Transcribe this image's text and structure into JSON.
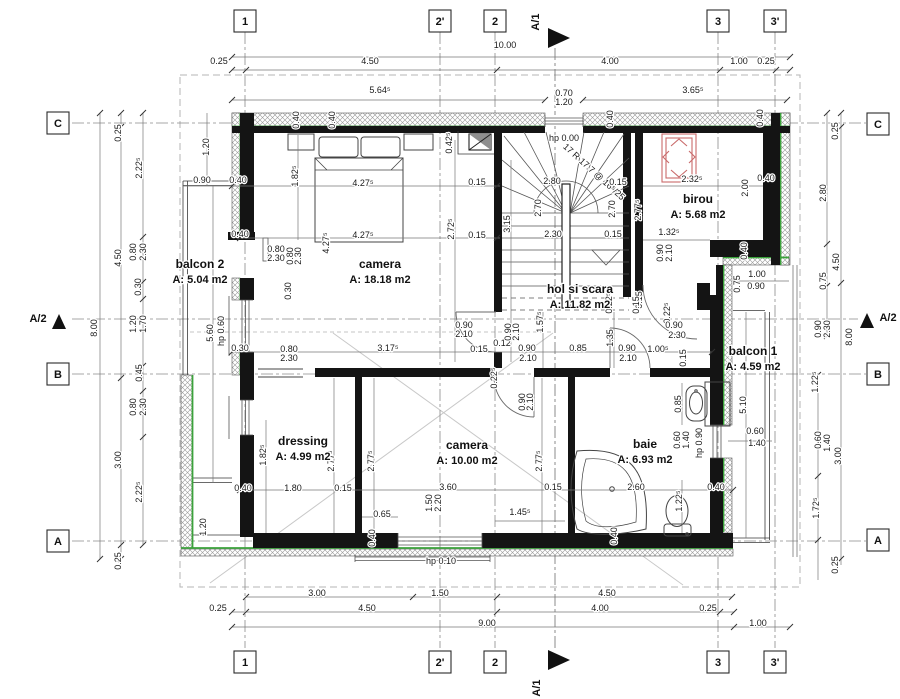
{
  "drawing": {
    "type": "architectural floor plan",
    "level_note_visible": false
  },
  "colors": {
    "wall": "#141414",
    "insulation_green": "#3ba23b",
    "red_element": "#c96a6a",
    "dim_text": "#1a1a1a",
    "grid_line": "#8a8a8a",
    "roof_dash": "#b5b5b5"
  },
  "rooms": [
    {
      "name": "balcon 2",
      "area": "A: 5.04 m2",
      "x": 200,
      "y": 268
    },
    {
      "name": "camera",
      "area": "A: 18.18 m2",
      "x": 380,
      "y": 268
    },
    {
      "name": "hol si scara",
      "area": "A: 11.82 m2",
      "x": 580,
      "y": 293
    },
    {
      "name": "birou",
      "area": "A: 5.68 m2",
      "x": 698,
      "y": 203
    },
    {
      "name": "dressing",
      "area": "A: 4.99 m2",
      "x": 303,
      "y": 445
    },
    {
      "name": "camera",
      "area": "A: 10.00 m2",
      "x": 467,
      "y": 449
    },
    {
      "name": "baie",
      "area": "A: 6.93 m2",
      "x": 645,
      "y": 448
    },
    {
      "name": "balcon 1",
      "area": "A: 4.59 m2",
      "x": 753,
      "y": 355
    }
  ],
  "grid": {
    "bubbles": [
      {
        "label": "1",
        "x": 245,
        "y": 21
      },
      {
        "label": "2'",
        "x": 440,
        "y": 21
      },
      {
        "label": "2",
        "x": 495,
        "y": 21
      },
      {
        "label": "3",
        "x": 718,
        "y": 21
      },
      {
        "label": "3'",
        "x": 775,
        "y": 21
      },
      {
        "label": "1",
        "x": 245,
        "y": 662
      },
      {
        "label": "2'",
        "x": 440,
        "y": 662
      },
      {
        "label": "2",
        "x": 495,
        "y": 662
      },
      {
        "label": "3",
        "x": 718,
        "y": 662
      },
      {
        "label": "3'",
        "x": 775,
        "y": 662
      },
      {
        "label": "C",
        "x": 58,
        "y": 123
      },
      {
        "label": "B",
        "x": 58,
        "y": 374
      },
      {
        "label": "A",
        "x": 58,
        "y": 541
      },
      {
        "label": "C",
        "x": 878,
        "y": 124
      },
      {
        "label": "B",
        "x": 878,
        "y": 374
      },
      {
        "label": "A",
        "x": 878,
        "y": 540
      }
    ]
  },
  "sections": [
    {
      "label": "A/1",
      "lx": 539,
      "ly": 22,
      "lr": -90,
      "tri": "548,28 548,48 570,38"
    },
    {
      "label": "A/1",
      "lx": 540,
      "ly": 688,
      "lr": -90,
      "tri": "548,650 548,670 570,660"
    },
    {
      "label": "A/2",
      "lx": 38,
      "ly": 322,
      "lr": 0,
      "tri": "52,329 66,329 59,314"
    },
    {
      "label": "A/2",
      "lx": 888,
      "ly": 321,
      "lr": 0,
      "tri": "860,328 874,328 867,313"
    }
  ],
  "dims": [
    {
      "t": "10.00",
      "x": 505,
      "y": 48
    },
    {
      "t": "0.25",
      "x": 219,
      "y": 64
    },
    {
      "t": "4.50",
      "x": 370,
      "y": 64
    },
    {
      "t": "4.00",
      "x": 610,
      "y": 64
    },
    {
      "t": "1.00",
      "x": 739,
      "y": 64
    },
    {
      "t": "0.25",
      "x": 766,
      "y": 64
    },
    {
      "t": "5.64⁵",
      "x": 380,
      "y": 93
    },
    {
      "t": "3.65⁵",
      "x": 693,
      "y": 93
    },
    {
      "t": "0.70",
      "x": 564,
      "y": 96,
      "s": 8
    },
    {
      "t": "1.20",
      "x": 564,
      "y": 105,
      "s": 8
    },
    {
      "t": "3.00",
      "x": 317,
      "y": 596
    },
    {
      "t": "1.50",
      "x": 440,
      "y": 596
    },
    {
      "t": "4.50",
      "x": 607,
      "y": 596
    },
    {
      "t": "0.25",
      "x": 218,
      "y": 611
    },
    {
      "t": "4.50",
      "x": 367,
      "y": 611
    },
    {
      "t": "4.00",
      "x": 600,
      "y": 611
    },
    {
      "t": "0.25",
      "x": 708,
      "y": 611
    },
    {
      "t": "9.00",
      "x": 487,
      "y": 626
    },
    {
      "t": "1.00",
      "x": 758,
      "y": 626
    },
    {
      "t": "8.00",
      "x": 97,
      "y": 328,
      "r": -90
    },
    {
      "t": "0.25",
      "x": 121,
      "y": 133,
      "r": -90
    },
    {
      "t": "4.50",
      "x": 121,
      "y": 258,
      "r": -90
    },
    {
      "t": "3.00",
      "x": 121,
      "y": 460,
      "r": -90
    },
    {
      "t": "0.25",
      "x": 121,
      "y": 561,
      "r": -90
    },
    {
      "t": "2.22⁵",
      "x": 142,
      "y": 168,
      "r": -90
    },
    {
      "t": "0.80",
      "x": 136,
      "y": 252,
      "r": -90
    },
    {
      "t": "2.30",
      "x": 146,
      "y": 252,
      "r": -90
    },
    {
      "t": "0.30",
      "x": 141,
      "y": 287,
      "r": -90
    },
    {
      "t": "1.20",
      "x": 136,
      "y": 324,
      "r": -90
    },
    {
      "t": "1.70",
      "x": 146,
      "y": 324,
      "r": -90
    },
    {
      "t": "0.45",
      "x": 142,
      "y": 373,
      "r": -90
    },
    {
      "t": "0.80",
      "x": 136,
      "y": 407,
      "r": -90
    },
    {
      "t": "2.30",
      "x": 146,
      "y": 407,
      "r": -90
    },
    {
      "t": "2.22⁵",
      "x": 142,
      "y": 492,
      "r": -90
    },
    {
      "t": "1.20",
      "x": 209,
      "y": 147,
      "r": -90
    },
    {
      "t": "0.90",
      "x": 202,
      "y": 183
    },
    {
      "t": "5.60",
      "x": 213,
      "y": 333,
      "r": -90
    },
    {
      "t": "hp 0.60",
      "x": 224,
      "y": 331,
      "r": -90,
      "s": 7.5
    },
    {
      "t": "1.20",
      "x": 206,
      "y": 527,
      "r": -90
    },
    {
      "t": "0.25",
      "x": 838,
      "y": 131,
      "r": -90
    },
    {
      "t": "2.80",
      "x": 826,
      "y": 193,
      "r": -90
    },
    {
      "t": "4.50",
      "x": 839,
      "y": 262,
      "r": -90
    },
    {
      "t": "0.75",
      "x": 826,
      "y": 281,
      "r": -90
    },
    {
      "t": "0.90",
      "x": 821,
      "y": 329,
      "r": -90
    },
    {
      "t": "2.30",
      "x": 830,
      "y": 329,
      "r": -90
    },
    {
      "t": "8.00",
      "x": 852,
      "y": 337,
      "r": -90
    },
    {
      "t": "1.22⁵",
      "x": 818,
      "y": 382,
      "r": -90
    },
    {
      "t": "0.60",
      "x": 821,
      "y": 440,
      "r": -90
    },
    {
      "t": "1.40",
      "x": 830,
      "y": 443,
      "r": -90
    },
    {
      "t": "3.00",
      "x": 841,
      "y": 456,
      "r": -90
    },
    {
      "t": "1.72⁵",
      "x": 819,
      "y": 508,
      "r": -90
    },
    {
      "t": "0.25",
      "x": 838,
      "y": 565,
      "r": -90
    },
    {
      "t": "0.40",
      "x": 238,
      "y": 183
    },
    {
      "t": "0.40",
      "x": 240,
      "y": 237
    },
    {
      "t": "1.82⁵",
      "x": 298,
      "y": 176,
      "r": -90
    },
    {
      "t": "4.27⁵",
      "x": 363,
      "y": 186
    },
    {
      "t": "4.27⁵",
      "x": 363,
      "y": 238
    },
    {
      "t": "4.27⁵",
      "x": 329,
      "y": 243,
      "r": -90
    },
    {
      "t": "0.80",
      "x": 276,
      "y": 252
    },
    {
      "t": "2.30",
      "x": 276,
      "y": 261
    },
    {
      "t": "0.80",
      "x": 293,
      "y": 256,
      "r": -90
    },
    {
      "t": "2.30",
      "x": 301,
      "y": 256,
      "r": -90
    },
    {
      "t": "0.30",
      "x": 291,
      "y": 291,
      "r": -90
    },
    {
      "t": "2.72⁵",
      "x": 454,
      "y": 229,
      "r": -90
    },
    {
      "t": "0.15",
      "x": 477,
      "y": 185
    },
    {
      "t": "0.15",
      "x": 477,
      "y": 238
    },
    {
      "t": "0.42⁵",
      "x": 452,
      "y": 143,
      "r": -90
    },
    {
      "t": "0.40",
      "x": 299,
      "y": 120,
      "r": -90,
      "s": 8
    },
    {
      "t": "0.40",
      "x": 335,
      "y": 120,
      "r": -90,
      "s": 8
    },
    {
      "t": "0.40",
      "x": 613,
      "y": 119,
      "r": -90,
      "s": 8
    },
    {
      "t": "0.40",
      "x": 763,
      "y": 118,
      "r": -90,
      "s": 8
    },
    {
      "t": "hp 0.00",
      "x": 564,
      "y": 141,
      "s": 8
    },
    {
      "t": "17 R 17.7 @ 16⁵/25",
      "x": 592,
      "y": 174,
      "r": 42,
      "s": 7.5
    },
    {
      "t": "2.80",
      "x": 552,
      "y": 184
    },
    {
      "t": "0.15",
      "x": 618,
      "y": 185
    },
    {
      "t": "2.70",
      "x": 541,
      "y": 208,
      "r": -90
    },
    {
      "t": "2.70",
      "x": 615,
      "y": 209,
      "r": -90
    },
    {
      "t": "3.15",
      "x": 510,
      "y": 224,
      "r": -90
    },
    {
      "t": "2.30",
      "x": 553,
      "y": 237
    },
    {
      "t": "0.15",
      "x": 613,
      "y": 237
    },
    {
      "t": "2.32⁵",
      "x": 692,
      "y": 182
    },
    {
      "t": "2.00",
      "x": 748,
      "y": 188,
      "r": -90
    },
    {
      "t": "0.40",
      "x": 766,
      "y": 181,
      "s": 8
    },
    {
      "t": "2.77⁵",
      "x": 641,
      "y": 210,
      "r": -90
    },
    {
      "t": "1.32⁵",
      "x": 669,
      "y": 235
    },
    {
      "t": "0.90",
      "x": 663,
      "y": 253,
      "r": -90
    },
    {
      "t": "2.10",
      "x": 672,
      "y": 253,
      "r": -90
    },
    {
      "t": "0.40",
      "x": 747,
      "y": 251,
      "r": -90
    },
    {
      "t": "1.00",
      "x": 757,
      "y": 277
    },
    {
      "t": "0.90",
      "x": 756,
      "y": 289
    },
    {
      "t": "0.75",
      "x": 740,
      "y": 284,
      "r": -90
    },
    {
      "t": "0.22⁵",
      "x": 670,
      "y": 313,
      "r": -90
    },
    {
      "t": "0.90",
      "x": 674,
      "y": 328
    },
    {
      "t": "2.30",
      "x": 677,
      "y": 338
    },
    {
      "t": "0.15",
      "x": 642,
      "y": 300,
      "r": -90
    },
    {
      "t": "0.30",
      "x": 240,
      "y": 351
    },
    {
      "t": "0.80",
      "x": 289,
      "y": 352
    },
    {
      "t": "2.30",
      "x": 289,
      "y": 361
    },
    {
      "t": "3.17⁵",
      "x": 388,
      "y": 351
    },
    {
      "t": "0.90",
      "x": 464,
      "y": 328
    },
    {
      "t": "2.10",
      "x": 464,
      "y": 337
    },
    {
      "t": "0.15",
      "x": 479,
      "y": 352
    },
    {
      "t": "0.12",
      "x": 502,
      "y": 346
    },
    {
      "t": "0.90",
      "x": 511,
      "y": 332,
      "r": -90
    },
    {
      "t": "2.10",
      "x": 519,
      "y": 332,
      "r": -90
    },
    {
      "t": "1.57⁵",
      "x": 543,
      "y": 322,
      "r": -90
    },
    {
      "t": "0.90",
      "x": 527,
      "y": 351
    },
    {
      "t": "2.10",
      "x": 528,
      "y": 361
    },
    {
      "t": "0.85",
      "x": 578,
      "y": 351
    },
    {
      "t": "1.35",
      "x": 613,
      "y": 338,
      "r": -90
    },
    {
      "t": "0.90",
      "x": 627,
      "y": 351
    },
    {
      "t": "2.10",
      "x": 628,
      "y": 361
    },
    {
      "t": "1.00⁵",
      "x": 658,
      "y": 352
    },
    {
      "t": "0.15",
      "x": 686,
      "y": 358,
      "r": -90
    },
    {
      "t": "0.22⁵",
      "x": 612,
      "y": 303,
      "r": -90
    },
    {
      "t": "0.15",
      "x": 639,
      "y": 305,
      "r": -90
    },
    {
      "t": "0.22⁵",
      "x": 497,
      "y": 378,
      "r": -90
    },
    {
      "t": "0.90",
      "x": 525,
      "y": 402,
      "r": -90
    },
    {
      "t": "2.10",
      "x": 533,
      "y": 402,
      "r": -90
    },
    {
      "t": "1.82⁵",
      "x": 266,
      "y": 455,
      "r": -90
    },
    {
      "t": "2.77⁵",
      "x": 334,
      "y": 461,
      "r": -90
    },
    {
      "t": "2.77⁵",
      "x": 374,
      "y": 461,
      "r": -90
    },
    {
      "t": "2.77⁵",
      "x": 542,
      "y": 461,
      "r": -90
    },
    {
      "t": "1.80",
      "x": 293,
      "y": 491
    },
    {
      "t": "0.15",
      "x": 343,
      "y": 491
    },
    {
      "t": "0.40",
      "x": 243,
      "y": 491
    },
    {
      "t": "0.65",
      "x": 382,
      "y": 517
    },
    {
      "t": "3.60",
      "x": 448,
      "y": 490
    },
    {
      "t": "1.50",
      "x": 432,
      "y": 503,
      "r": -90
    },
    {
      "t": "2.20",
      "x": 441,
      "y": 503,
      "r": -90
    },
    {
      "t": "0.40",
      "x": 375,
      "y": 538,
      "r": -90
    },
    {
      "t": "1.45⁵",
      "x": 520,
      "y": 515
    },
    {
      "t": "0.15",
      "x": 553,
      "y": 490
    },
    {
      "t": "2.60",
      "x": 636,
      "y": 490
    },
    {
      "t": "0.40",
      "x": 716,
      "y": 490
    },
    {
      "t": "hp 0.10",
      "x": 441,
      "y": 564,
      "s": 8
    },
    {
      "t": "0.40",
      "x": 617,
      "y": 536,
      "r": -90
    },
    {
      "t": "0.85",
      "x": 681,
      "y": 404,
      "r": -90
    },
    {
      "t": "0.60",
      "x": 680,
      "y": 440,
      "r": -90
    },
    {
      "t": "1.40",
      "x": 689,
      "y": 440,
      "r": -90
    },
    {
      "t": "hp 0.90",
      "x": 702,
      "y": 443,
      "r": -90,
      "s": 7.5
    },
    {
      "t": "1.22⁵",
      "x": 682,
      "y": 501,
      "r": -90
    },
    {
      "t": "5.10",
      "x": 746,
      "y": 405,
      "r": -90
    },
    {
      "t": "0.60",
      "x": 755,
      "y": 434
    },
    {
      "t": "1.40",
      "x": 757,
      "y": 446
    }
  ],
  "dim_lines": [
    [
      232,
      57,
      790,
      57
    ],
    [
      232,
      70,
      790,
      70
    ],
    [
      232,
      100,
      545,
      100
    ],
    [
      583,
      100,
      787,
      100
    ],
    [
      246,
      597,
      732,
      597
    ],
    [
      232,
      612,
      734,
      612
    ],
    [
      232,
      627,
      734,
      627
    ],
    [
      734,
      627,
      790,
      627
    ],
    [
      100,
      113,
      100,
      559
    ],
    [
      121,
      113,
      121,
      559
    ],
    [
      143,
      113,
      143,
      545
    ],
    [
      827,
      113,
      827,
      336
    ],
    [
      841,
      113,
      841,
      565
    ],
    [
      818,
      375,
      818,
      580
    ],
    [
      183,
      186,
      500,
      186
    ],
    [
      238,
      238,
      500,
      238
    ],
    [
      232,
      352,
      712,
      352
    ],
    [
      240,
      490,
      733,
      490
    ],
    [
      643,
      186,
      763,
      186
    ],
    [
      643,
      240,
      710,
      240
    ],
    [
      733,
      281,
      789,
      281
    ],
    [
      728,
      441,
      772,
      441
    ],
    [
      495,
      521,
      565,
      521
    ],
    [
      362,
      517,
      398,
      517
    ],
    [
      298,
      135,
      298,
      240
    ],
    [
      455,
      140,
      455,
      362
    ],
    [
      511,
      160,
      511,
      362
    ],
    [
      543,
      312,
      543,
      368
    ],
    [
      614,
      312,
      614,
      368
    ],
    [
      266,
      420,
      266,
      533
    ],
    [
      334,
      378,
      334,
      533
    ],
    [
      374,
      378,
      374,
      533
    ],
    [
      542,
      378,
      542,
      533
    ],
    [
      682,
      383,
      682,
      425
    ],
    [
      682,
      480,
      682,
      533
    ],
    [
      746,
      312,
      746,
      538
    ],
    [
      207,
      113,
      207,
      186
    ],
    [
      213,
      186,
      213,
      483
    ]
  ],
  "ticks": [
    [
      232,
      57
    ],
    [
      790,
      57
    ],
    [
      232,
      70
    ],
    [
      246,
      70
    ],
    [
      497,
      70
    ],
    [
      720,
      70
    ],
    [
      776,
      70
    ],
    [
      790,
      70
    ],
    [
      232,
      100
    ],
    [
      545,
      100
    ],
    [
      583,
      100
    ],
    [
      787,
      100
    ],
    [
      246,
      597
    ],
    [
      413,
      597
    ],
    [
      497,
      597
    ],
    [
      732,
      597
    ],
    [
      232,
      612
    ],
    [
      246,
      612
    ],
    [
      497,
      612
    ],
    [
      720,
      612
    ],
    [
      734,
      612
    ],
    [
      232,
      627
    ],
    [
      734,
      627
    ],
    [
      790,
      627
    ],
    [
      100,
      113
    ],
    [
      100,
      559
    ],
    [
      121,
      113
    ],
    [
      121,
      127
    ],
    [
      121,
      378
    ],
    [
      121,
      545
    ],
    [
      121,
      559
    ],
    [
      143,
      113
    ],
    [
      143,
      237
    ],
    [
      143,
      282
    ],
    [
      143,
      299
    ],
    [
      143,
      366
    ],
    [
      143,
      391
    ],
    [
      143,
      437
    ],
    [
      143,
      545
    ],
    [
      827,
      113
    ],
    [
      827,
      244
    ],
    [
      827,
      286
    ],
    [
      827,
      336
    ],
    [
      841,
      113
    ],
    [
      841,
      127
    ],
    [
      841,
      283
    ],
    [
      841,
      559
    ],
    [
      818,
      375
    ],
    [
      818,
      443
    ],
    [
      818,
      476
    ],
    [
      818,
      540
    ],
    [
      232,
      186
    ],
    [
      497,
      186
    ],
    [
      240,
      238
    ],
    [
      497,
      238
    ],
    [
      232,
      352
    ],
    [
      712,
      352
    ],
    [
      240,
      490
    ],
    [
      733,
      490
    ]
  ]
}
